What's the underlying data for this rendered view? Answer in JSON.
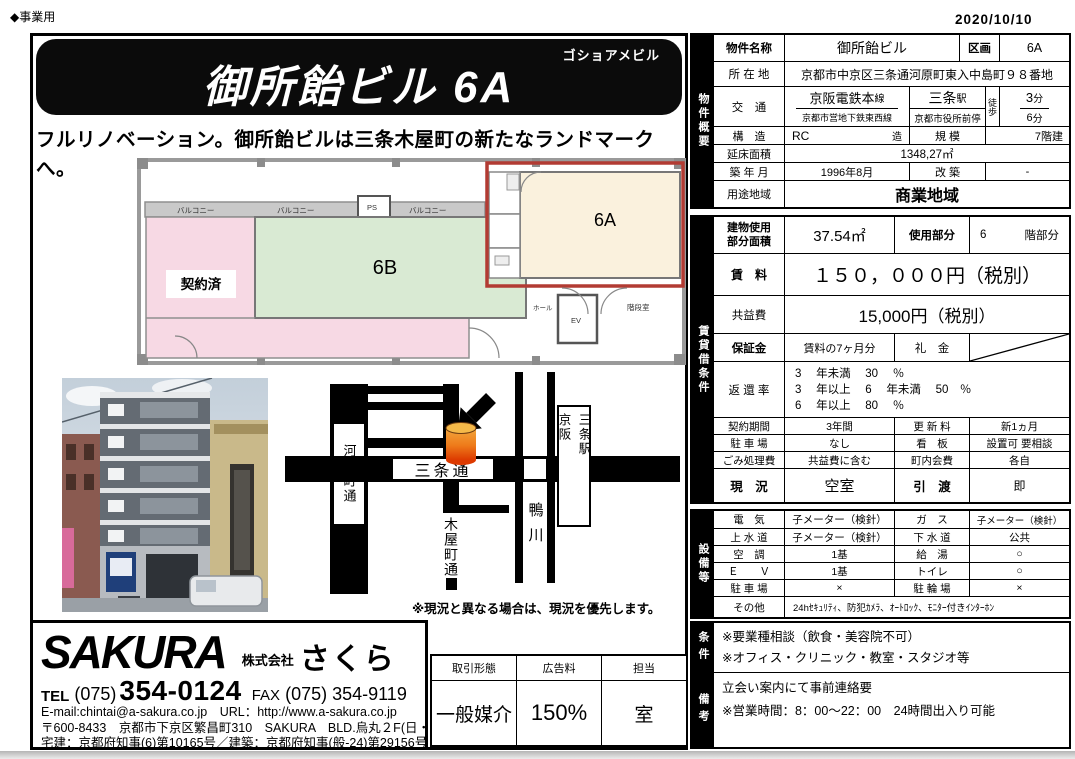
{
  "page": {
    "business_type": "◆事業用",
    "date": "2020/10/10"
  },
  "banner": {
    "furigana": "ゴショアメビル",
    "title": "御所飴ビル 6A",
    "tagline": "フルリノベーション。御所飴ビルは三条木屋町の新たなランドマークへ。"
  },
  "floorplan": {
    "balcony": "バルコニー",
    "ps": "PS",
    "contracted": "契約済",
    "unit_b": "6B",
    "unit_a": "6A",
    "hall": "ホール",
    "ev": "EV",
    "stairs": "階段室"
  },
  "map": {
    "kawaramachi": "河原町通",
    "sanjo": "三条通",
    "kiyamachi": "木屋町通",
    "kamo": "鴨川",
    "station_left": "京阪",
    "station_right": "三条駅",
    "note": "※現況と異なる場合は、現況を優先します。"
  },
  "overview": {
    "label": "物件概要",
    "r1l": "物件名称",
    "r1v": "御所飴ビル",
    "r1l2": "区画",
    "r1v2": "6A",
    "r2l": "所 在 地",
    "r2v": "京都市中京区三条通河原町東入中島町９８番地",
    "r3l": "交　通",
    "line1": "京阪電鉄本",
    "line1_sfx": "線",
    "st1": "三条",
    "st1_sfx": "駅",
    "line2": "京都市営地下鉄東西",
    "line2_sfx": "線",
    "st2": "京都市役所前",
    "st2_sfx": "停",
    "walk": "徒歩",
    "min1": "3",
    "min1_sfx": "分",
    "min2": "6",
    "min2_sfx": "分",
    "r4l": "構　造",
    "r4v": "RC",
    "r4v_sfx": "造",
    "r4l2": "規 模",
    "r4v2": "7階建",
    "r5l": "延床面積",
    "r5v": "1348,27㎡",
    "r6l": "築 年 月",
    "r6v": "1996年8月",
    "r6l2": "改 築",
    "r6v2": "-",
    "r7l": "用途地域",
    "r7v": "商業地域"
  },
  "lease": {
    "label": "賃貸借条件",
    "area_l1": "建物使用",
    "area_l2": "部分面積",
    "area_v": "37.54㎡",
    "part_l": "使用部分",
    "part_num": "6",
    "part_sfx": "階部分",
    "rent_l": "賃　料",
    "rent_v": "１５０，０００円（税別）",
    "fee_l": "共益費",
    "fee_v": "15,000円（税別）",
    "deposit_l": "保証金",
    "deposit_v": "賃料の7ヶ月分",
    "key_l": "礼　金",
    "refund_l": "返 還 率",
    "refund1": "3　 年未満 　30　 ％",
    "refund2": "3　 年以上 　6　 年未満 　50　％",
    "refund3": "6　 年以上 　80　 ％",
    "term_l": "契約期間",
    "term_v": "3年間",
    "renew_l": "更 新 料",
    "renew_v": "新1ヵ月",
    "park_l": "駐 車 場",
    "park_v": "なし",
    "sign_l": "看　板",
    "sign_v": "設置可 要相談",
    "trash_l": "ごみ処理費",
    "trash_v": "共益費に含む",
    "assoc_l": "町内会費",
    "assoc_v": "各自",
    "status_l": "現　況",
    "status_v": "空室",
    "hand_l": "引　渡",
    "hand_v": "即"
  },
  "facilities": {
    "label": "設備等",
    "elec_l": "電　気",
    "elec_v": "子メーター（検針）",
    "gas_l": "ガ　ス",
    "gas_v": "子メーター（検針）",
    "water_l": "上 水 道",
    "water_v": "子メーター（検針）",
    "sewer_l": "下 水 道",
    "sewer_v": "公共",
    "ac_l": "空　調",
    "ac_v": "1基",
    "hw_l": "給　湯",
    "hw_v": "○",
    "ev_l": "Ｅ　　Ｖ",
    "ev_v": "1基",
    "toilet_l": "トイレ",
    "toilet_v": "○",
    "park_l": "駐 車 場",
    "park_v": "×",
    "bike_l": "駐 輪 場",
    "bike_v": "×",
    "other_l": "その他",
    "other_v": "24hｾｷｭﾘﾃｨ、防犯ｶﾒﾗ、ｵｰﾄﾛｯｸ、ﾓﾆﾀｰ付きｲﾝﾀｰﾎﾝ"
  },
  "conditions": {
    "label": "条件",
    "line1": "※要業種相談（飲食・美容院不可）",
    "line2": "※オフィス・クリニック・教室・スタジオ等"
  },
  "remarks": {
    "label": "備考",
    "line1": "立会い案内にて事前連絡要",
    "line2": "※営業時間：8：00～22：00　24時間出入り可能"
  },
  "agency": {
    "logo": "SAKURA",
    "corp": "株式会社",
    "name": "さくら",
    "tel_label": "TEL",
    "tel_area": "(075)",
    "tel_num": "354-0124",
    "fax_label": "FAX",
    "fax_num": "(075) 354-9119",
    "email_url": "E-mail:chintai@a-sakura.co.jp　URL：http://www.a-sakura.co.jp",
    "address": "〒600-8433　京都市下京区繁昌町310　SAKURA　BLD.烏丸２F(日・祝休)",
    "license": "宅建：京都府知事(6)第10165号／建築：京都府知事(般-24)第29156号"
  },
  "transaction": {
    "type_l": "取引形態",
    "type_v": "一般媒介",
    "ad_l": "広告料",
    "ad_v": "150%",
    "staff_l": "担当",
    "staff_v": "室"
  },
  "colors": {
    "highlight_red": "#b23b33",
    "plan_pink": "#f7d9e4",
    "plan_green": "#d9ead3",
    "plan_cream": "#faf1dd",
    "marker_orange": "#f2a73d",
    "marker_red": "#dd3a00"
  }
}
